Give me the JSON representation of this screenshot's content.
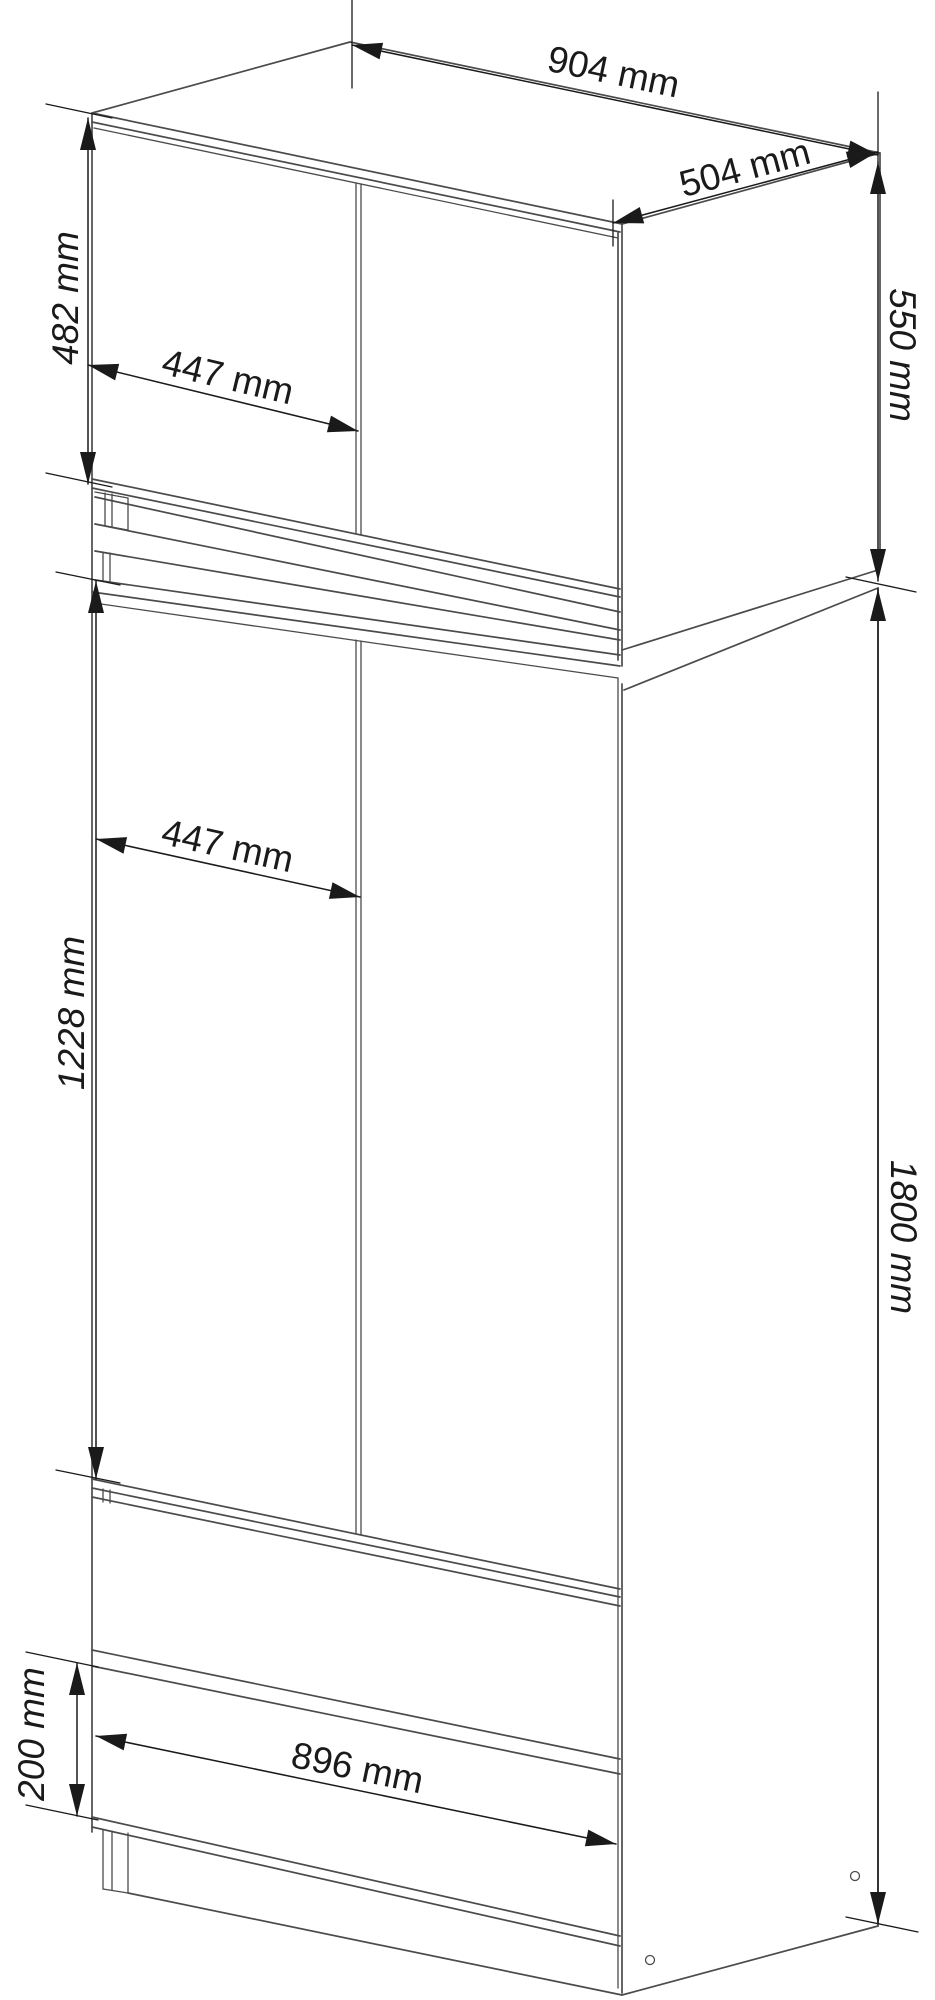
{
  "diagram": {
    "type": "furniture-dimension-drawing",
    "subject": "wardrobe with top cabinet, two doors and two drawers",
    "unit": "mm",
    "colors": {
      "bg": "#ffffff",
      "line": "#4b4b4b",
      "dim": "#1a1a1a"
    },
    "dimensions": {
      "overall_width": {
        "label": "904 mm",
        "value": 904,
        "applies_to": "overall top width"
      },
      "depth": {
        "label": "504 mm",
        "value": 504,
        "applies_to": "overall depth"
      },
      "top_door_height": {
        "label": "482 mm",
        "value": 482,
        "applies_to": "top cabinet door height"
      },
      "top_door_width": {
        "label": "447 mm",
        "value": 447,
        "applies_to": "top cabinet door width"
      },
      "top_section_height": {
        "label": "550 mm",
        "value": 550,
        "applies_to": "top cabinet height"
      },
      "door_width": {
        "label": "447 mm",
        "value": 447,
        "applies_to": "wardrobe door width"
      },
      "door_height": {
        "label": "1228 mm",
        "value": 1228,
        "applies_to": "wardrobe door height"
      },
      "wardrobe_height": {
        "label": "1800 mm",
        "value": 1800,
        "applies_to": "wardrobe body height"
      },
      "drawer_height": {
        "label": "200 mm",
        "value": 200,
        "applies_to": "drawer front height"
      },
      "drawer_width": {
        "label": "896 mm",
        "value": 896,
        "applies_to": "drawer front width"
      }
    }
  }
}
